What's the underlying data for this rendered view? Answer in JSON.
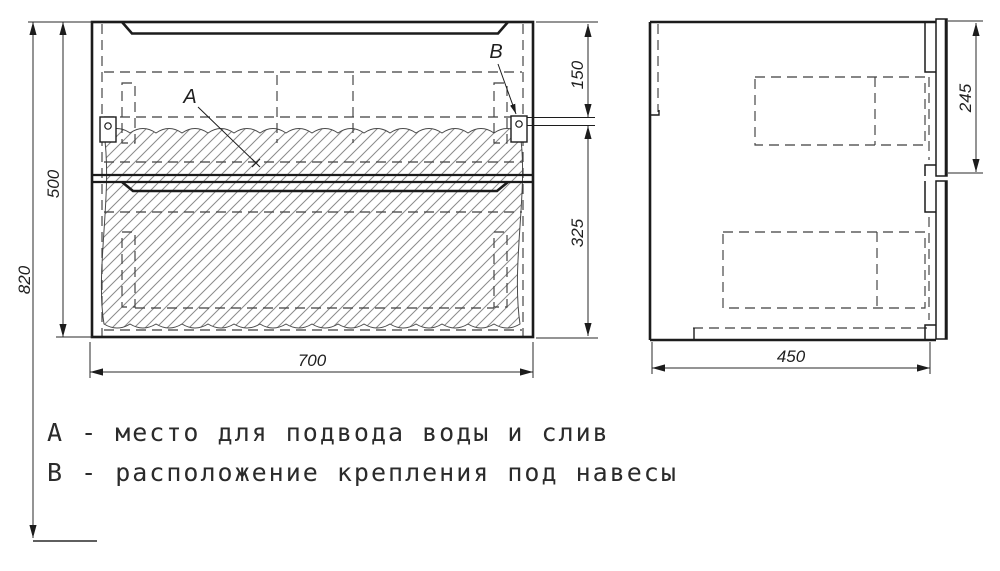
{
  "drawing": {
    "legend": {
      "line_a": "А - место для подвода воды и слив",
      "line_b": "В - расположение крепления под навесы"
    },
    "callouts": {
      "a": "А",
      "b": "В"
    },
    "dimensions": {
      "overall_height": "820",
      "cabinet_height": "500",
      "width": "700",
      "top_to_mount": "150",
      "mount_to_bottom": "325",
      "depth": "450",
      "drawer_front_height": "245"
    },
    "colors": {
      "line": "#1c1c1c",
      "dashed": "#3f3f3f",
      "hatch": "#8a8a8a",
      "background": "#ffffff"
    }
  }
}
